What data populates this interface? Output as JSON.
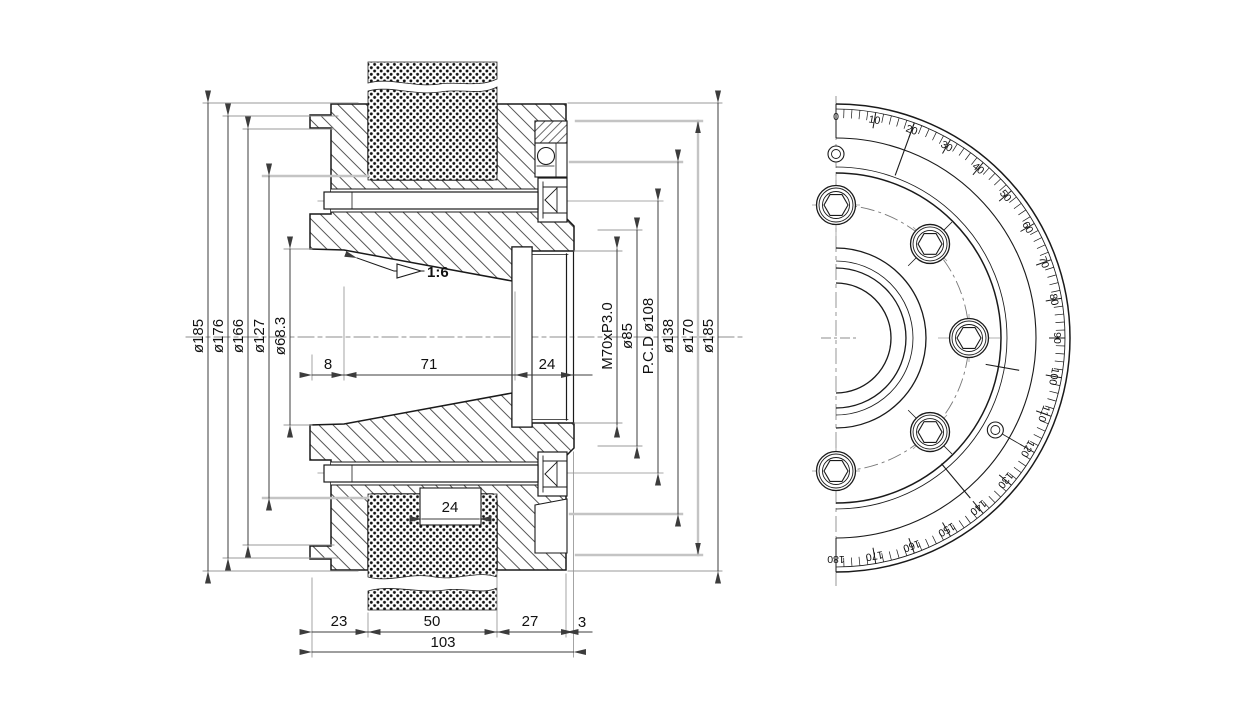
{
  "drawing_type": "technical engineering drawing, section view and graduated front view",
  "section_view": {
    "taper": {
      "label": "1:6"
    },
    "left_diameter_labels": [
      "ø185",
      "ø176",
      "ø166",
      "ø127",
      "ø68.3"
    ],
    "right_diameter_labels": [
      "M70xP3.0",
      "ø85",
      "P.C.D ø108",
      "ø138",
      "ø170",
      "ø185"
    ],
    "top_length_dims": [
      "8",
      "71",
      "24"
    ],
    "groove_width_dim": "24",
    "bottom_length_dims": [
      "23",
      "50",
      "27",
      "3"
    ],
    "overall_length_dim": "103"
  },
  "front_view": {
    "angle_scale": {
      "min": 0,
      "max": 180,
      "major_step": 10,
      "minor_step": 2,
      "labels": [
        "0",
        "10",
        "20",
        "30",
        "40",
        "50",
        "60",
        "70",
        "80",
        "90",
        "100",
        "110",
        "120",
        "130",
        "140",
        "150",
        "160",
        "170",
        "180"
      ],
      "index_angles": [
        20,
        100,
        140
      ]
    },
    "socket_screws_visible": 5,
    "small_holes_visible": 2
  },
  "colors": {
    "background": "#ffffff",
    "line": "#1a1a1a",
    "dimension": "#3c3c3c",
    "extension": "#9a9a9a",
    "phantom": "#c4c4c4",
    "centerline": "#8c8c8c"
  }
}
